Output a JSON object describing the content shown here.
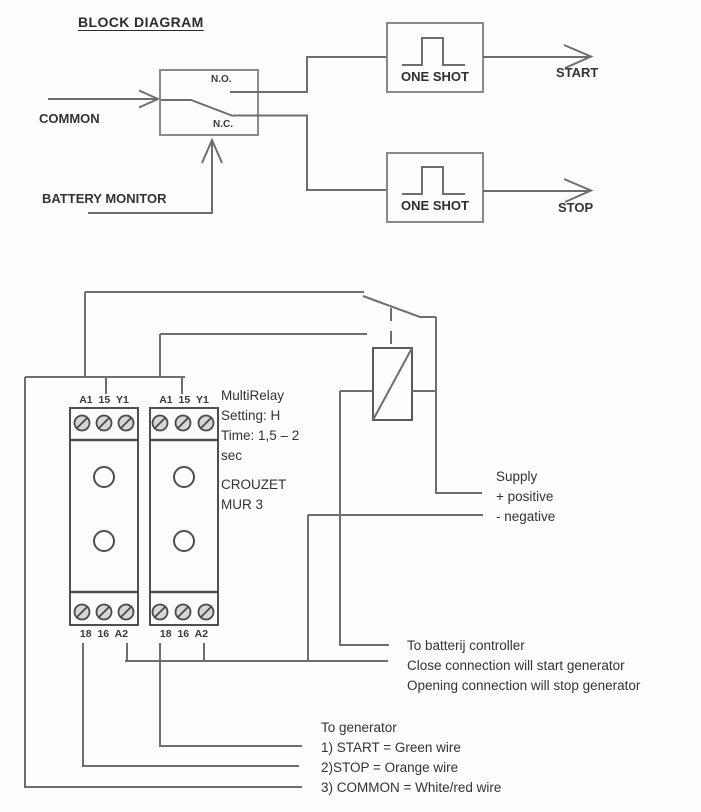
{
  "block_diagram": {
    "title": "BLOCK DIAGRAM",
    "common_label": "COMMON",
    "battery_monitor_label": "BATTERY MONITOR",
    "contact": {
      "no": "N.O.",
      "nc": "N.C."
    },
    "one_shot_start_label": "ONE SHOT",
    "one_shot_stop_label": "ONE SHOT",
    "start_label": "START",
    "stop_label": "STOP"
  },
  "wiring": {
    "module1": {
      "top_terminals": "A1 15 Y1",
      "bottom_terminals": "18 16 A2"
    },
    "module2": {
      "top_terminals": "A1 15 Y1",
      "bottom_terminals": "18 16 A2"
    },
    "note": [
      "MultiRelay",
      "Setting: H",
      "Time: 1,5 – 2",
      "sec",
      "CROUZET",
      "MUR 3"
    ],
    "supply": [
      "Supply",
      "+ positive",
      "- negative"
    ],
    "battery_controller": [
      "To batterij controller",
      "Close connection will start generator",
      "Opening connection will stop generator"
    ],
    "generator": [
      "To generator",
      "1) START = Green wire",
      "2)STOP = Orange wire",
      "3) COMMON = White/red wire"
    ]
  },
  "colors": {
    "wire": "#6e6e6e",
    "box_border": "#8a8a8a",
    "module_border": "#4f4f4f",
    "text": "#383838",
    "background": "#fdfdfd"
  }
}
